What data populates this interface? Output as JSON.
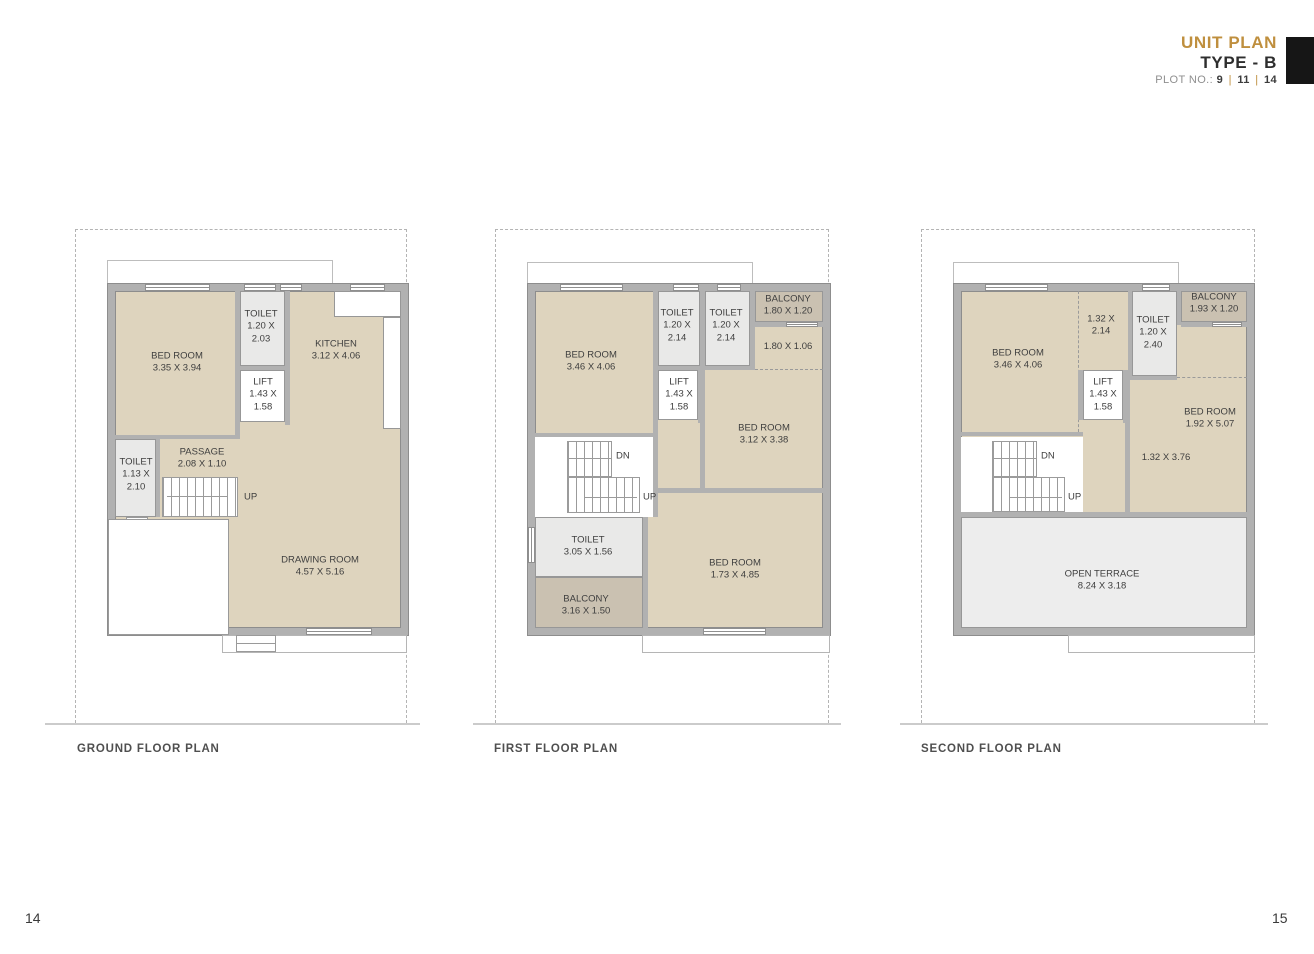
{
  "header": {
    "title": "UNIT PLAN",
    "subtitle": "TYPE - B",
    "plot_prefix": "PLOT NO.:",
    "plot_numbers": [
      "9",
      "11",
      "14"
    ],
    "divider": "|",
    "accent_color": "#bf8f3e"
  },
  "plans": {
    "ground": {
      "caption": "GROUND FLOOR PLAN",
      "labels": {
        "bedroom": {
          "lines": [
            "BED ROOM",
            "3.35 X 3.94"
          ]
        },
        "toilet_top": {
          "lines": [
            "TOILET",
            "1.20 X",
            "2.03"
          ]
        },
        "lift": {
          "lines": [
            "LIFT",
            "1.43 X",
            "1.58"
          ]
        },
        "kitchen": {
          "lines": [
            "KITCHEN",
            "3.12 X 4.06"
          ]
        },
        "toilet_left": {
          "lines": [
            "TOILET",
            "1.13 X",
            "2.10"
          ]
        },
        "passage": {
          "lines": [
            "PASSAGE",
            "2.08 X 1.10"
          ]
        },
        "drawing_room": {
          "lines": [
            "DRAWING ROOM",
            "4.57 X 5.16"
          ]
        },
        "up": "UP"
      }
    },
    "first": {
      "caption": "FIRST FLOOR PLAN",
      "labels": {
        "bedroom_1": {
          "lines": [
            "BED ROOM",
            "3.46 X 4.06"
          ]
        },
        "toilet_1": {
          "lines": [
            "TOILET",
            "1.20 X",
            "2.14"
          ]
        },
        "toilet_2": {
          "lines": [
            "TOILET",
            "1.20 X",
            "2.14"
          ]
        },
        "balcony_1": {
          "lines": [
            "BALCONY",
            "1.80 X 1.20"
          ]
        },
        "area_1": {
          "lines": [
            "1.80 X 1.06"
          ]
        },
        "lift": {
          "lines": [
            "LIFT",
            "1.43 X",
            "1.58"
          ]
        },
        "bedroom_2": {
          "lines": [
            "BED ROOM",
            "3.12 X 3.38"
          ]
        },
        "toilet_3": {
          "lines": [
            "TOILET",
            "3.05 X 1.56"
          ]
        },
        "balcony_2": {
          "lines": [
            "BALCONY",
            "3.16 X 1.50"
          ]
        },
        "bedroom_3": {
          "lines": [
            "BED ROOM",
            "1.73 X 4.85"
          ]
        },
        "dn": "DN",
        "up": "UP"
      }
    },
    "second": {
      "caption": "SECOND FLOOR PLAN",
      "labels": {
        "bedroom_1": {
          "lines": [
            "BED ROOM",
            "3.46 X 4.06"
          ]
        },
        "area_1": {
          "lines": [
            "1.32 X",
            "2.14"
          ]
        },
        "toilet": {
          "lines": [
            "TOILET",
            "1.20 X",
            "2.40"
          ]
        },
        "balcony": {
          "lines": [
            "BALCONY",
            "1.93 X 1.20"
          ]
        },
        "lift": {
          "lines": [
            "LIFT",
            "1.43 X",
            "1.58"
          ]
        },
        "bedroom_2": {
          "lines": [
            "BED ROOM",
            "1.92 X 5.07"
          ]
        },
        "area_2": {
          "lines": [
            "1.32 X 3.76"
          ]
        },
        "open_terrace": {
          "lines": [
            "OPEN TERRACE",
            "8.24 X 3.18"
          ]
        },
        "dn": "DN",
        "up": "UP"
      }
    }
  },
  "footer": {
    "page_left": "14",
    "page_right": "15"
  },
  "colors": {
    "accent_gold": "#bf8f3e",
    "wall_gray": "#b1b1b1",
    "room_beige": "#ded4be",
    "balcony_tan": "#cac1b1",
    "toilet_gray": "#e9e9e8",
    "terrace_gray": "#ededed"
  }
}
